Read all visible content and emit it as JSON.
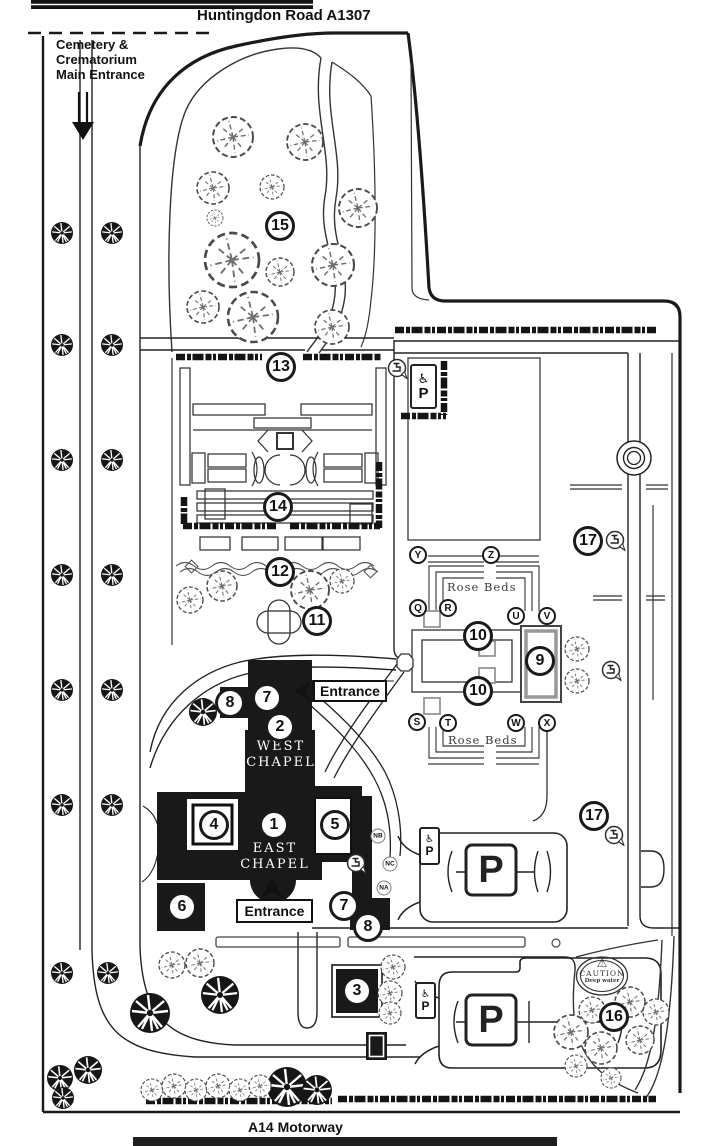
{
  "roads": {
    "top_label": "Huntingdon Road A1307",
    "bottom_label": "A14 Motorway"
  },
  "entrance_note": {
    "lines": [
      "Cemetery &",
      "Crematorium",
      "Main Entrance"
    ]
  },
  "labels": {
    "entrance": "Entrance",
    "rose_beds": "Rose Beds",
    "west_chapel": [
      "WEST",
      "CHAPEL"
    ],
    "east_chapel": [
      "EAST",
      "CHAPEL"
    ],
    "parking_letter": "P",
    "caution_title": "CAUTION",
    "caution_subtitle": "Deep water"
  },
  "icons": {
    "wheelchair": "♿",
    "warning_triangle": "⚠"
  },
  "markers": {
    "numbers": [
      {
        "label": "1",
        "x": 274,
        "y": 825
      },
      {
        "label": "2",
        "x": 280,
        "y": 727
      },
      {
        "label": "3",
        "x": 357,
        "y": 991
      },
      {
        "label": "4",
        "x": 214,
        "y": 825
      },
      {
        "label": "5",
        "x": 335,
        "y": 825
      },
      {
        "label": "6",
        "x": 182,
        "y": 907
      },
      {
        "label": "7",
        "x": 267,
        "y": 698
      },
      {
        "label": "7",
        "x": 344,
        "y": 906
      },
      {
        "label": "8",
        "x": 230,
        "y": 703
      },
      {
        "label": "8",
        "x": 368,
        "y": 927
      },
      {
        "label": "9",
        "x": 540,
        "y": 661
      },
      {
        "label": "10",
        "x": 478,
        "y": 636
      },
      {
        "label": "10",
        "x": 478,
        "y": 691
      },
      {
        "label": "11",
        "x": 317,
        "y": 621
      },
      {
        "label": "12",
        "x": 280,
        "y": 572
      },
      {
        "label": "13",
        "x": 281,
        "y": 367
      },
      {
        "label": "14",
        "x": 278,
        "y": 507
      },
      {
        "label": "15",
        "x": 280,
        "y": 226
      },
      {
        "label": "16",
        "x": 614,
        "y": 1017
      },
      {
        "label": "17",
        "x": 588,
        "y": 541
      },
      {
        "label": "17",
        "x": 594,
        "y": 816
      }
    ],
    "letters": [
      {
        "label": "Y",
        "x": 418,
        "y": 555
      },
      {
        "label": "Z",
        "x": 491,
        "y": 555
      },
      {
        "label": "Q",
        "x": 418,
        "y": 608
      },
      {
        "label": "R",
        "x": 448,
        "y": 608
      },
      {
        "label": "U",
        "x": 516,
        "y": 616
      },
      {
        "label": "V",
        "x": 547,
        "y": 616
      },
      {
        "label": "S",
        "x": 417,
        "y": 722
      },
      {
        "label": "T",
        "x": 448,
        "y": 723
      },
      {
        "label": "W",
        "x": 516,
        "y": 723
      },
      {
        "label": "X",
        "x": 547,
        "y": 723
      }
    ],
    "niche_letters": [
      {
        "label": "NB",
        "x": 378,
        "y": 836
      },
      {
        "label": "NC",
        "x": 390,
        "y": 864
      },
      {
        "label": "NA",
        "x": 384,
        "y": 888
      }
    ],
    "water_taps": [
      {
        "x": 397,
        "y": 368
      },
      {
        "x": 615,
        "y": 540
      },
      {
        "x": 611,
        "y": 670
      },
      {
        "x": 614,
        "y": 835
      },
      {
        "x": 356,
        "y": 863
      }
    ]
  }
}
